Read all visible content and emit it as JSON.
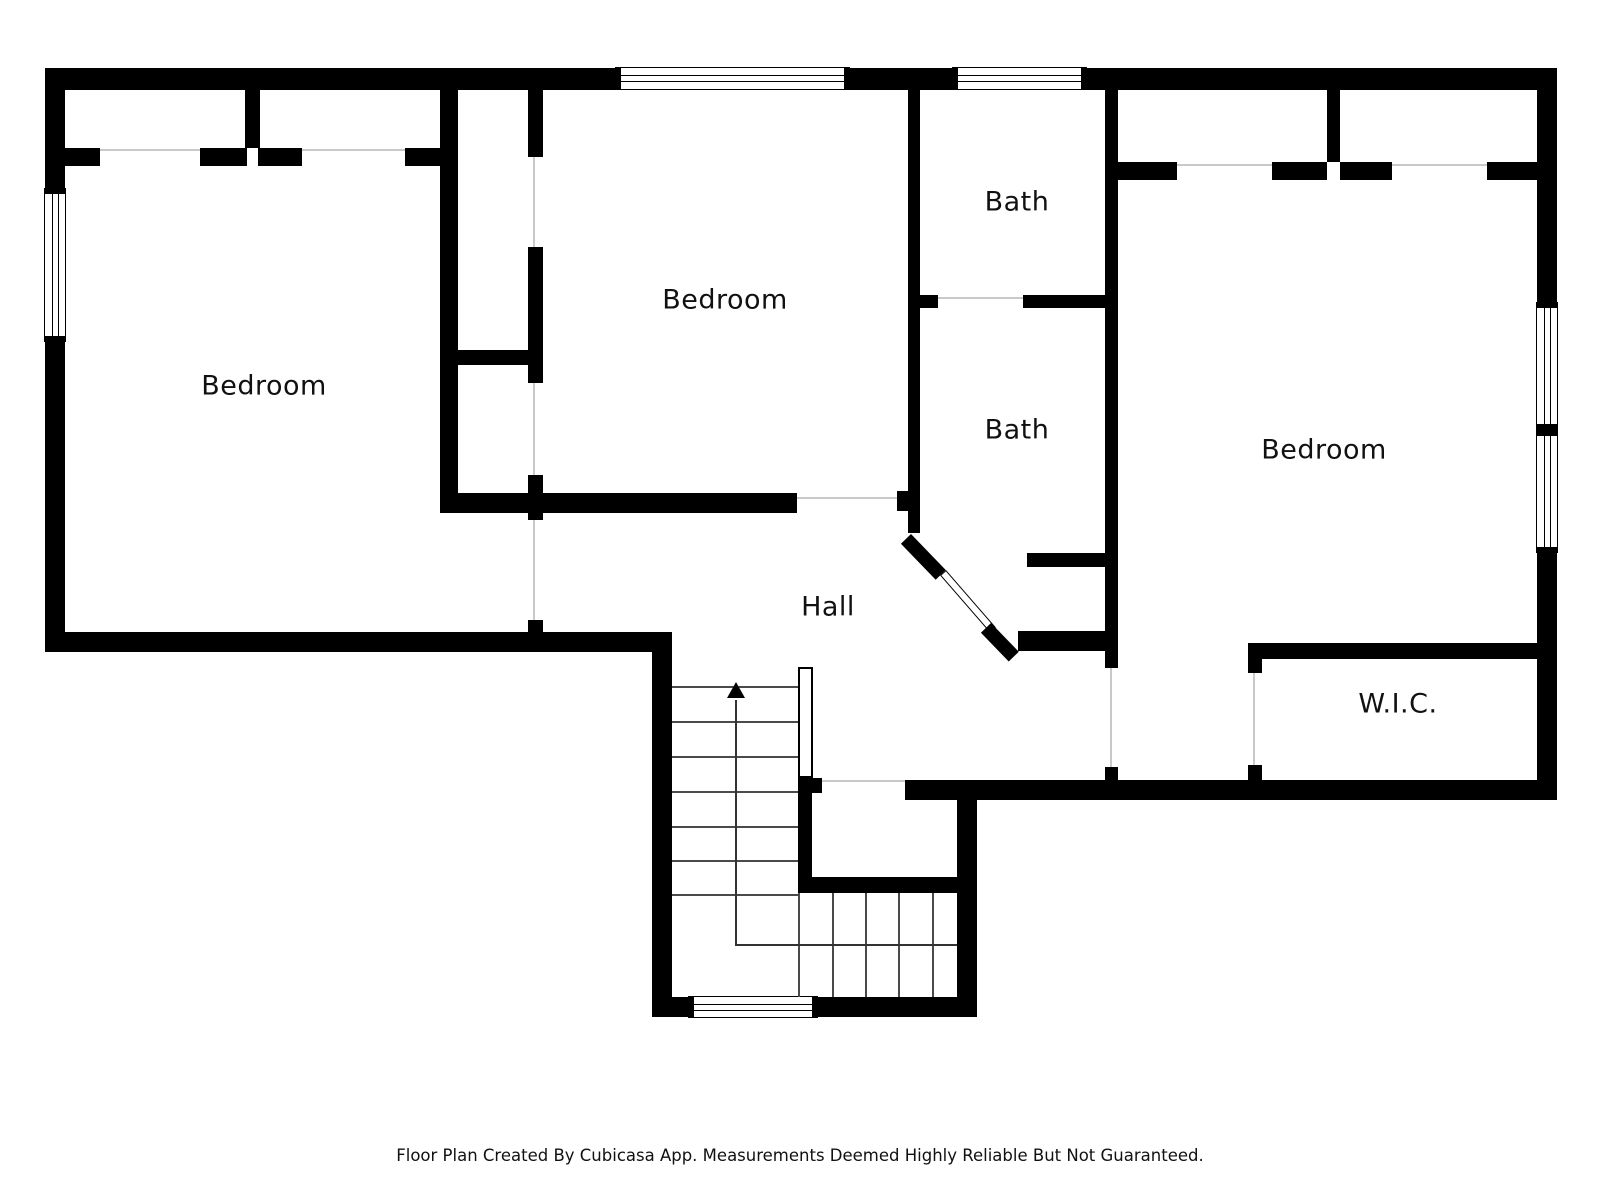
{
  "rooms": [
    {
      "id": "bedroom-left",
      "label": "Bedroom"
    },
    {
      "id": "bedroom-middle",
      "label": "Bedroom"
    },
    {
      "id": "bath-upper",
      "label": "Bath"
    },
    {
      "id": "bath-lower",
      "label": "Bath"
    },
    {
      "id": "bedroom-right",
      "label": "Bedroom"
    },
    {
      "id": "hall",
      "label": "Hall"
    },
    {
      "id": "walk-in-closet",
      "label": "W.I.C."
    }
  ],
  "stairs": {
    "direction_icon": "up-arrow"
  },
  "footer": {
    "disclaimer": "Floor Plan Created By Cubicasa App. Measurements Deemed Highly Reliable But Not Guaranteed."
  },
  "colors": {
    "wall": "#000000",
    "background": "#ffffff",
    "label_text": "#111111",
    "door_opening_line": "#c9c9c9",
    "stair_line": "#4a4a4a"
  }
}
